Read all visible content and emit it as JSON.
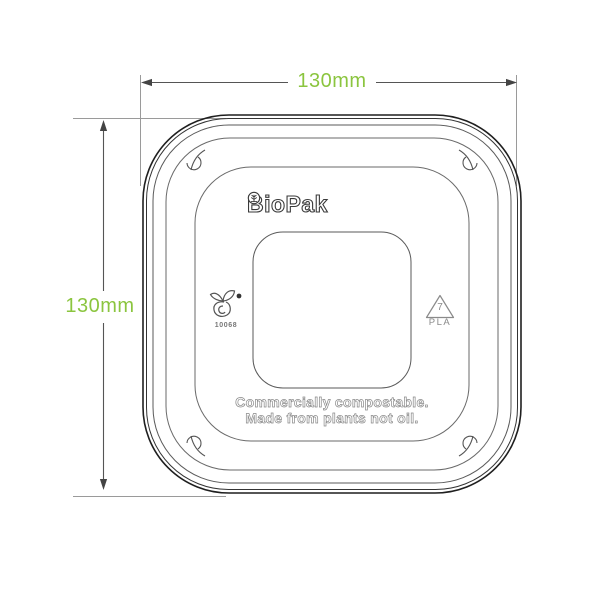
{
  "colors": {
    "green": "#8bc53f",
    "line": "#3f3f3f",
    "muted": "#8a8a8a"
  },
  "dimensions": {
    "width_label": "130mm",
    "height_label": "130mm"
  },
  "lid": {
    "brand": "BioPak",
    "seedling_license": "10068",
    "resin_code": "7",
    "resin_material": "PLA",
    "claim_line1": "Commercially compostable.",
    "claim_line2": "Made from plants not oil."
  },
  "icons": {
    "logo_emblem": "tree-in-circle-icon",
    "certification": "seedling-compostable-icon",
    "resin": "recycling-triangle-icon",
    "corner_details": "lid-corner-tab-icon"
  }
}
